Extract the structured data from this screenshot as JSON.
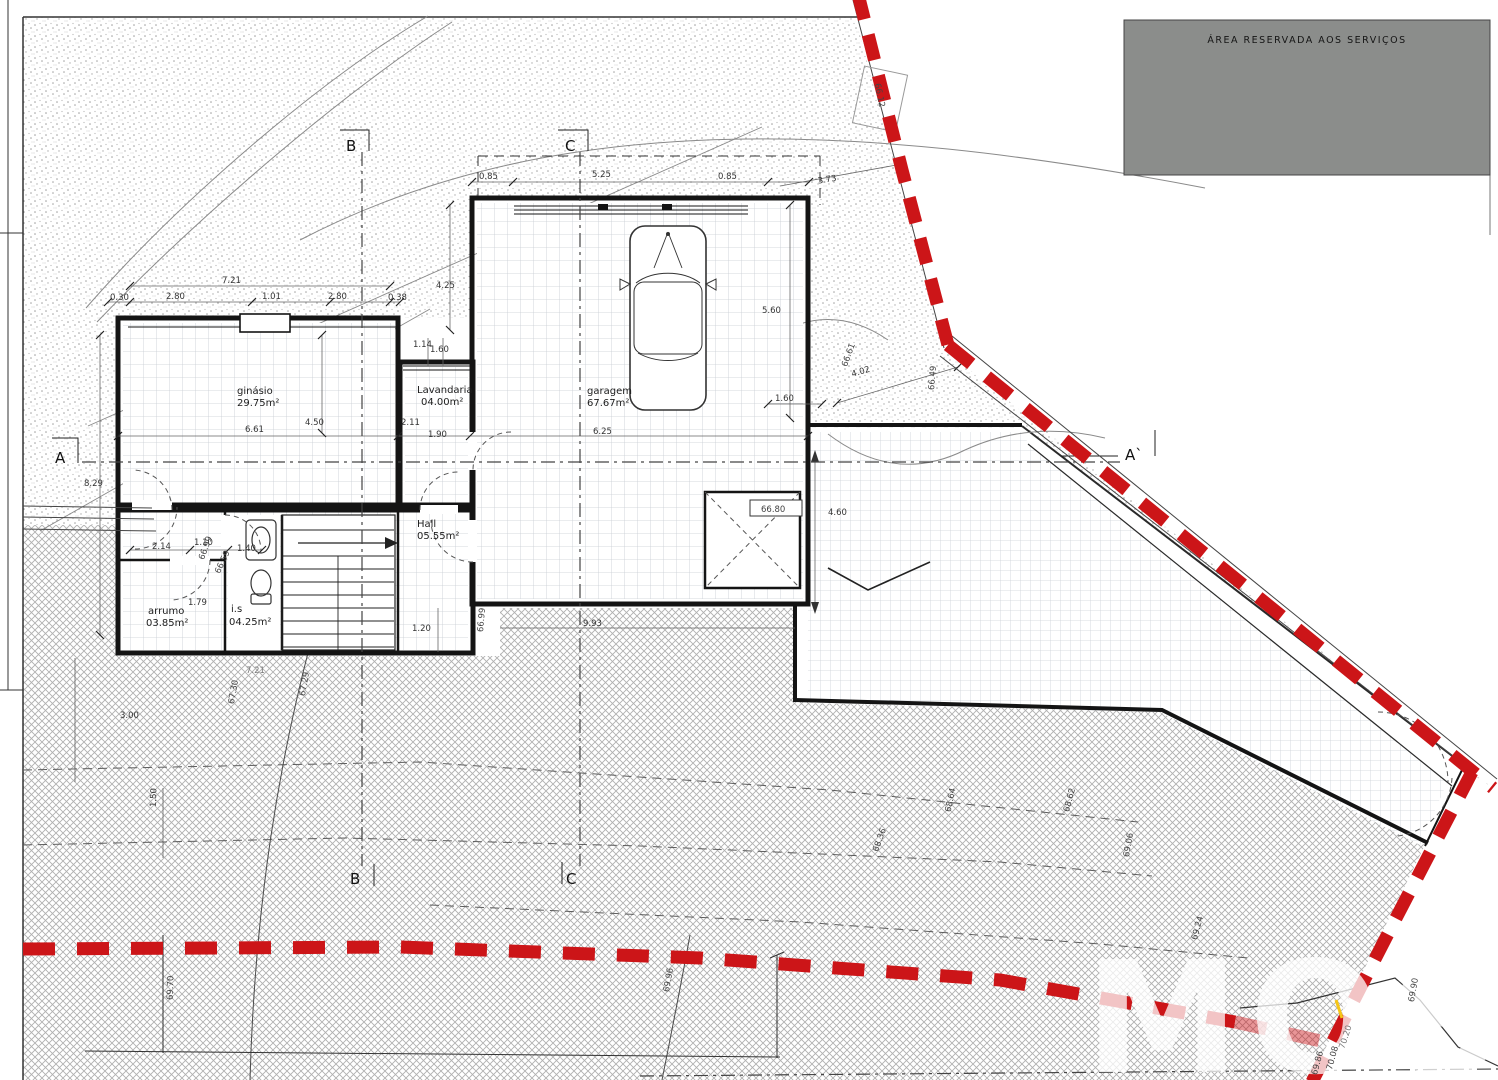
{
  "reserved_area_label": "ÁREA RESERVADA AOS SERVIÇOS",
  "watermark": "MOS",
  "colors": {
    "boundary": "#cc1518",
    "reserved_box": "#8b8d8b"
  },
  "sections": {
    "a": "A",
    "a_prime": "A`",
    "b": "B",
    "c": "C"
  },
  "rooms": {
    "ginasio": {
      "name": "ginásio",
      "area": "29.75m²"
    },
    "lavandaria": {
      "name": "Lavandaria",
      "area": "04.00m²"
    },
    "garagem": {
      "name": "garagem",
      "area": "67.67m²"
    },
    "hall": {
      "name": "Hall",
      "area": "05.55m²"
    },
    "arrumo": {
      "name": "arrumo",
      "area": "03.85m²"
    },
    "is": {
      "name": "i.s",
      "area": "04.25m²"
    }
  },
  "dims": {
    "top_721": "7.21",
    "top_030": "0.30",
    "top_280a": "2.80",
    "top_101": "1.01",
    "top_280b": "2.80",
    "top_038": "0.38",
    "gar_085a": "0.85",
    "gar_525": "5.25",
    "gar_085b": "0.85",
    "gar_373": "3.73",
    "v425": "4.25",
    "v114": "1.14",
    "v160": "1.60",
    "v560": "5.60",
    "d402": "4.02",
    "p160": "1.60",
    "mid_661": "6.61",
    "mid_450": "4.50",
    "mid_211": "2.11",
    "mid_190": "1.90",
    "mid_625": "6.25",
    "left_829": "8.29",
    "e214": "2.14",
    "e110": "1.10",
    "e140": "1.40",
    "e179": "1.79",
    "b120": "1.20",
    "b993": "9.93",
    "b721": "7.21",
    "r460": "4.60",
    "l300": "3.00",
    "l150": "1.50"
  },
  "elev": {
    "e66_12": "66.12",
    "e66_61": "66.61",
    "e66_49": "66.49",
    "e66_80": "66.80",
    "e66_99a": "66.99",
    "e66_59": "66.59",
    "e66_99b": "66.99",
    "e67_30": "67.30",
    "e67_29": "67.29",
    "e68_36": "68.36",
    "e68_64": "68.64",
    "e68_62": "68.62",
    "e69_06": "69.06",
    "e69_24": "69.24",
    "e69_70": "69.70",
    "e69_96": "69.96",
    "e69_90": "69.90",
    "e70_20": "70.20",
    "e70_08": "70.08",
    "e69_86": "69.86"
  }
}
